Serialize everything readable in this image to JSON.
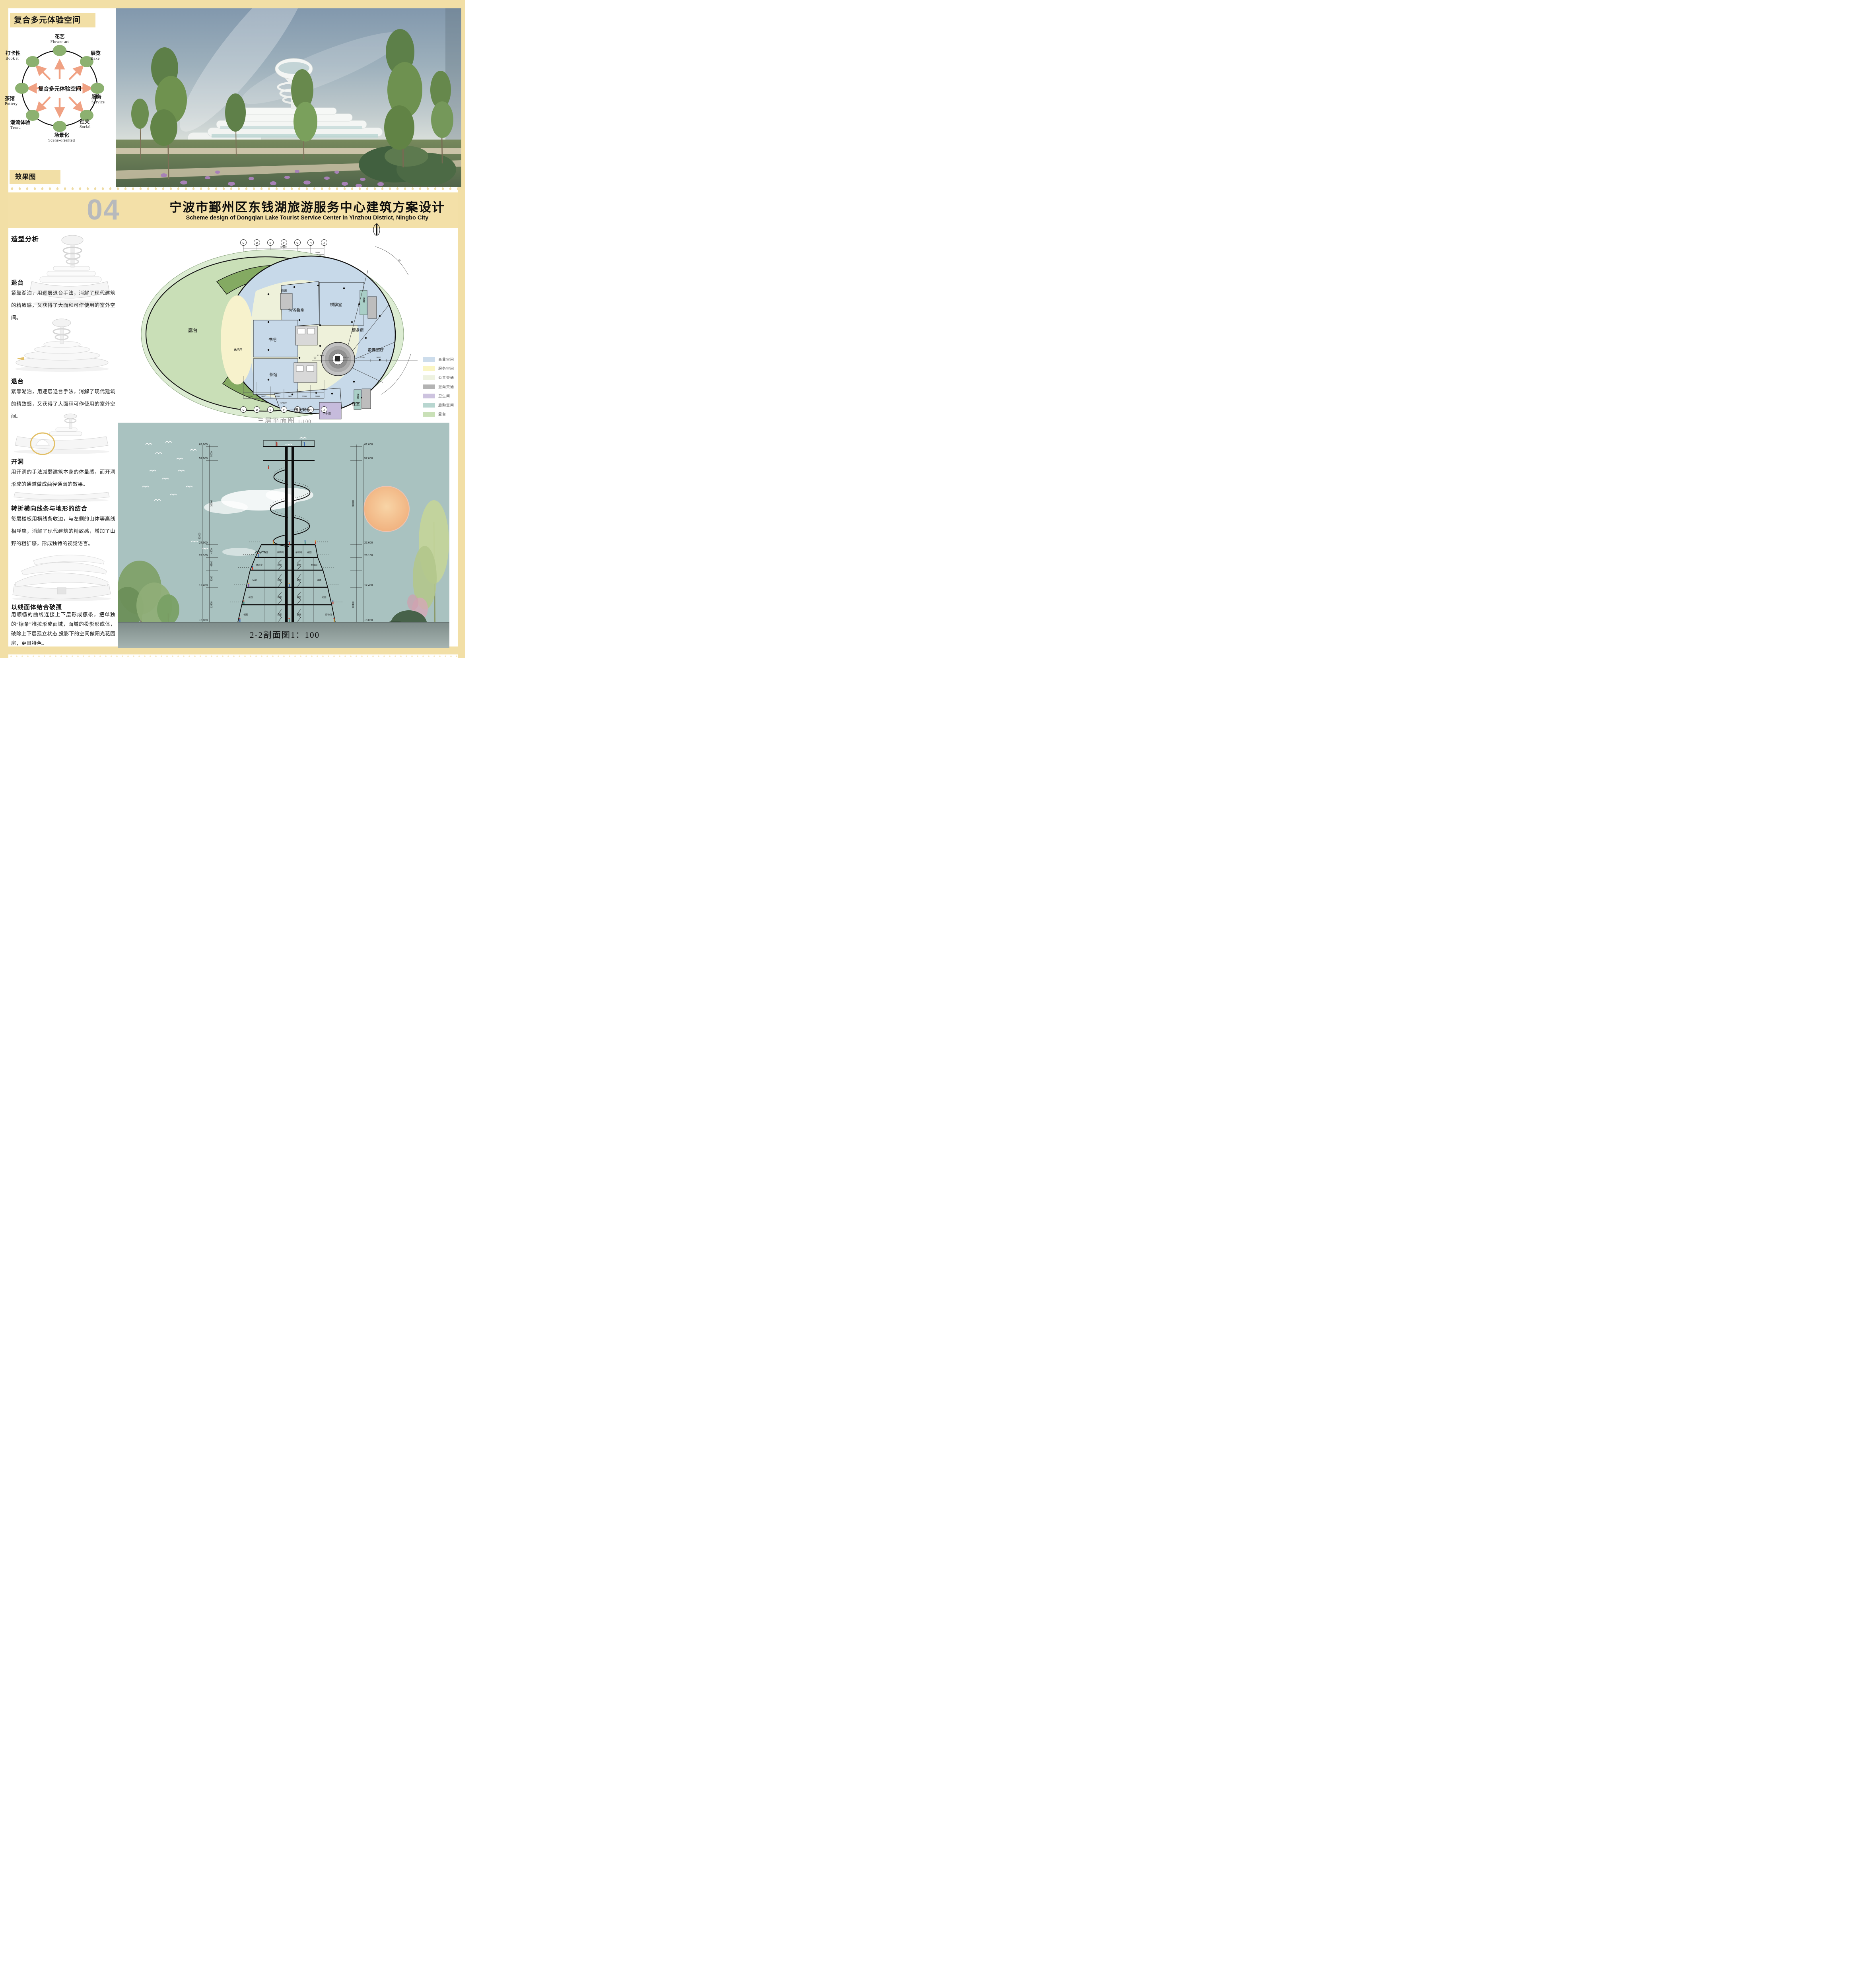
{
  "diagram": {
    "header": "复合多元体验空间",
    "center": "复合多元体验空间",
    "nodes": [
      {
        "zh": "花艺",
        "en": "Flower  art"
      },
      {
        "zh": "展览",
        "en": "Bake"
      },
      {
        "zh": "服务",
        "en": "Service"
      },
      {
        "zh": "社交",
        "en": "Social"
      },
      {
        "zh": "场景化",
        "en": "Scene-oriented"
      },
      {
        "zh": "潮流体验",
        "en": "Trend"
      },
      {
        "zh": "茶馆",
        "en": "Pottery"
      },
      {
        "zh": "打卡性",
        "en": "Book  it"
      }
    ]
  },
  "effect_label": "效果图",
  "title": {
    "number": "04",
    "zh": "宁波市鄞州区东钱湖旅游服务中心建筑方案设计",
    "en": "Scheme design of Dongqian Lake Tourist Service Center in Yinzhou District, Ningbo City"
  },
  "form_analysis": {
    "heading": "造型分析",
    "sections": [
      {
        "title": "退台",
        "text": "紧靠湖泊，用逐层退台手法，消解了现代建筑的精致感，又获得了大面积可作使用的室外空间。"
      },
      {
        "title": "退台",
        "text": "紧靠湖泊，用逐层退台手法，消解了现代建筑的精致感，又获得了大面积可作使用的室外空间。"
      },
      {
        "title": "开洞",
        "text": "用开洞的手法减弱建筑本身的体量感，而开洞形成的通道做成曲径通幽的效果。"
      },
      {
        "title": "转折横向线条与地形的结合",
        "text": "每层楼板用横线条收边，与左侧的山体等高线相呼应，消解了现代建筑的精致感，增加了山野的粗犷感，形成独特的视觉语言。"
      },
      {
        "title": "以线面体结合破孤",
        "text": "用顺畅的曲线连接上下层形成檩条，把单独的“檩条”推拉形成面域，面域的投影形成体，破除上下层孤立状态,投影下的空间做阳光花园房，更具特色。"
      }
    ]
  },
  "plan": {
    "caption": "三层平面图",
    "scale": "1:100",
    "grid": {
      "bubbles": [
        "C",
        "D",
        "E",
        "F",
        "G",
        "H",
        "J"
      ],
      "bay": "9600",
      "total": "57609"
    },
    "angle": "30°",
    "elevation": "12.400",
    "dims": [
      "9420",
      "9790",
      "9600"
    ],
    "rooms": {
      "terrace": "露台",
      "garden": "花园",
      "bath": "洗浴桑拿",
      "chess": "棋牌室",
      "storage": "储藏",
      "gym": "健身房",
      "book": "书吧",
      "lounge": "休闲厅",
      "dance": "歌舞酒厅",
      "tea": "茶馆",
      "esports": "电竞娱乐",
      "wc": "卫生间",
      "billiard": "球室",
      "void": "上空"
    },
    "legend": [
      {
        "label": "商业空间",
        "color": "#cdddec"
      },
      {
        "label": "服务空间",
        "color": "#faf5c3"
      },
      {
        "label": "公共交通",
        "color": "#eef2e0"
      },
      {
        "label": "竖向交通",
        "color": "#b3b3b3"
      },
      {
        "label": "卫生间",
        "color": "#cdc3df"
      },
      {
        "label": "后勤空间",
        "color": "#b8d6d0"
      },
      {
        "label": "露台",
        "color": "#c9e0b7"
      }
    ]
  },
  "section": {
    "caption": "2-2剖面图1：100",
    "levels": [
      "62.600",
      "57.600",
      "27.600",
      "23.100",
      "12.400",
      "±0.000",
      "-0.300"
    ],
    "dims": [
      "5000",
      "30000",
      "4500",
      "4500",
      "6200",
      "12400",
      "62900"
    ],
    "rooms": {
      "garden": "花园",
      "sundry": "杂物间",
      "rest": "休息室",
      "storage": "储藏",
      "front": "前室",
      "linen": "布草间"
    }
  }
}
